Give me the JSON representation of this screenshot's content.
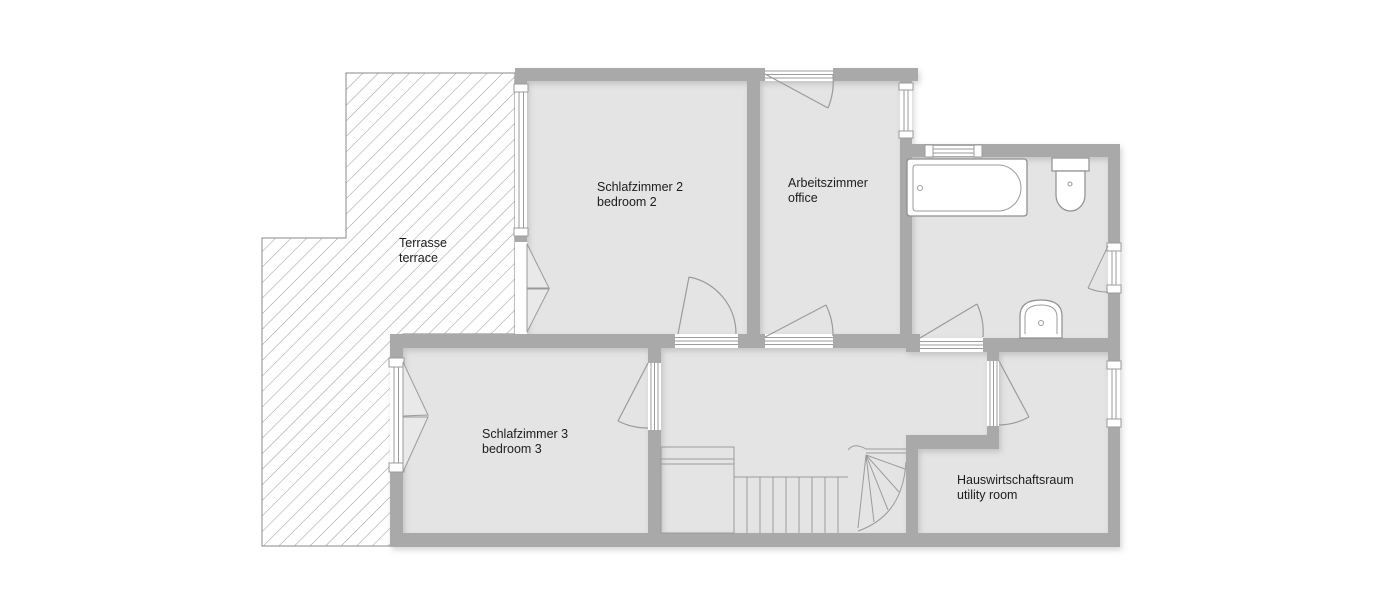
{
  "plan": {
    "type": "floor-plan",
    "rooms": [
      {
        "id": "terrace",
        "label_de": "Terrasse",
        "label_en": "terrace"
      },
      {
        "id": "bedroom-2",
        "label_de": "Schlafzimmer 2",
        "label_en": "bedroom 2"
      },
      {
        "id": "office",
        "label_de": "Arbeitszimmer",
        "label_en": "office"
      },
      {
        "id": "bedroom-3",
        "label_de": "Schlafzimmer 3",
        "label_en": "bedroom 3"
      },
      {
        "id": "utility-room",
        "label_de": "Hauswirtschaftsraum",
        "label_en": "utility room"
      }
    ],
    "fixtures": [
      "bathtub",
      "toilet",
      "washbasin",
      "staircase"
    ],
    "colors": {
      "wall": "#a9a9a9",
      "floor": "#e4e4e4",
      "line": "#9b9b9b",
      "hatch": "#8f8f8f",
      "background": "#ffffff"
    }
  }
}
